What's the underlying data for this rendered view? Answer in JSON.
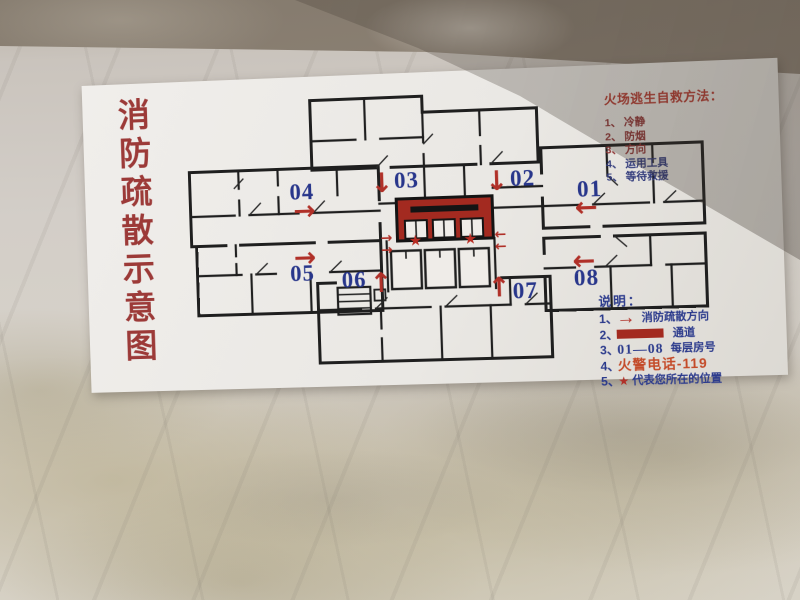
{
  "sign": {
    "title_chars": [
      "消",
      "防",
      "疏",
      "散",
      "示",
      "意",
      "图"
    ],
    "self_rescue": {
      "title": "火场逃生自救方法：",
      "items": [
        {
          "num": "1、",
          "text": "冷静"
        },
        {
          "num": "2、",
          "text": "防烟"
        },
        {
          "num": "3、",
          "text": "方向"
        },
        {
          "num": "4、",
          "text": "运用工具"
        },
        {
          "num": "5、",
          "text": "等待救援"
        }
      ]
    },
    "legend": {
      "title": "说明：",
      "items": {
        "evac": {
          "num": "1、",
          "text": "消防疏散方向"
        },
        "corridor": {
          "num": "2、",
          "text": "通道"
        },
        "rooms": {
          "num": "3、",
          "range": "01—08",
          "text": "每层房号"
        },
        "phone": {
          "num": "4、",
          "text": "火警电话-119"
        },
        "star": {
          "num": "5、",
          "glyph": "★",
          "text": "代表您所在的位置"
        }
      }
    },
    "plan": {
      "rooms": [
        {
          "label": "01"
        },
        {
          "label": "02"
        },
        {
          "label": "03"
        },
        {
          "label": "04"
        },
        {
          "label": "05"
        },
        {
          "label": "06"
        },
        {
          "label": "07"
        },
        {
          "label": "08"
        }
      ],
      "glyphs": {
        "up": "↑",
        "down": "↓",
        "left": "←",
        "right": "→",
        "star": "★"
      }
    },
    "colors": {
      "title_red": "#9c3a38",
      "room_number_blue": "#28368b",
      "arrow_red": "#b03028",
      "corridor_fill_red": "#a32a20",
      "legend_text_blue": "#2b3a8c",
      "alarm_phone_red": "#c44a28",
      "wall_marble": "#d3cec8",
      "sign_background": "#eae8e4"
    }
  }
}
